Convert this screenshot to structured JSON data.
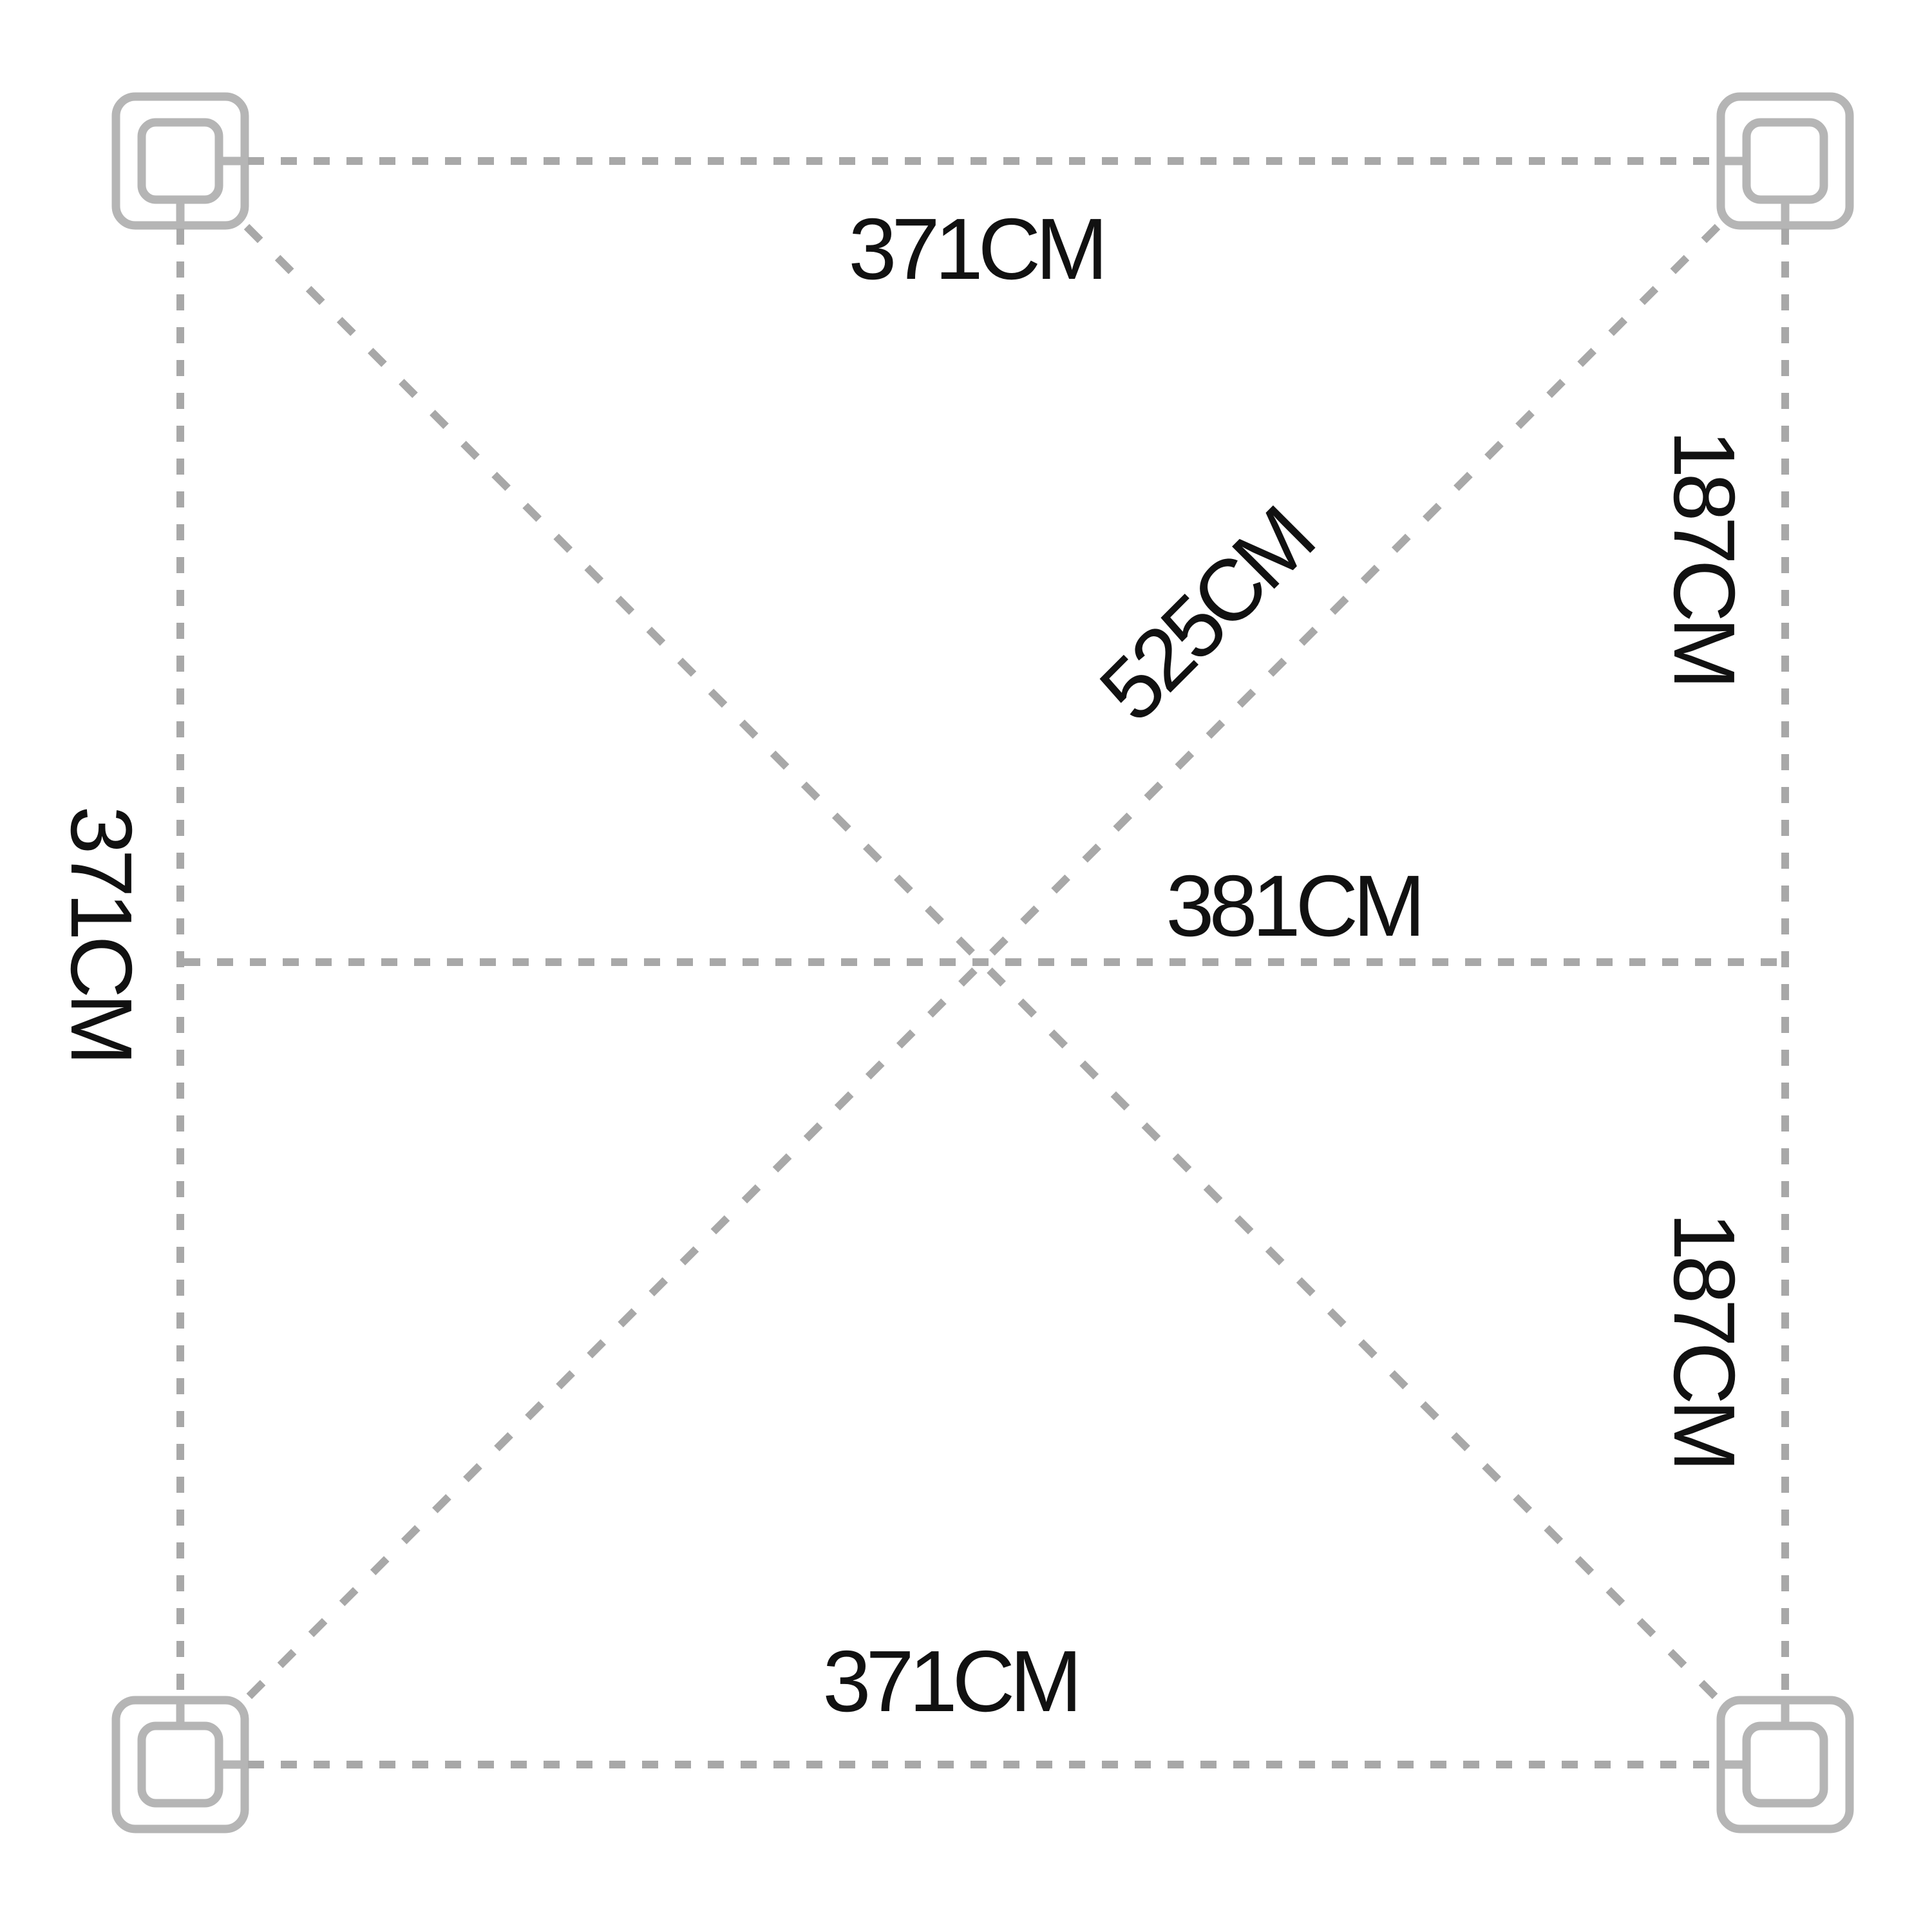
{
  "figure": {
    "kind": "canopy-footprint-dimension-diagram",
    "background": "#ffffff",
    "line_color": "#a8a8a8",
    "post_color": "#b5b5b5",
    "text_color": "#111111",
    "unit": "CM"
  },
  "dimensions": {
    "top": {
      "label": "371CM",
      "value": 371,
      "unit": "CM"
    },
    "left": {
      "label": "371CM",
      "value": 371,
      "unit": "CM"
    },
    "bottom": {
      "label": "371CM",
      "value": 371,
      "unit": "CM"
    },
    "right_upper": {
      "label": "187CM",
      "value": 187,
      "unit": "CM"
    },
    "right_lower": {
      "label": "187CM",
      "value": 187,
      "unit": "CM"
    },
    "center_horizontal": {
      "label": "381CM",
      "value": 381,
      "unit": "CM"
    },
    "diagonal": {
      "label": "525CM",
      "value": 525,
      "unit": "CM"
    }
  }
}
